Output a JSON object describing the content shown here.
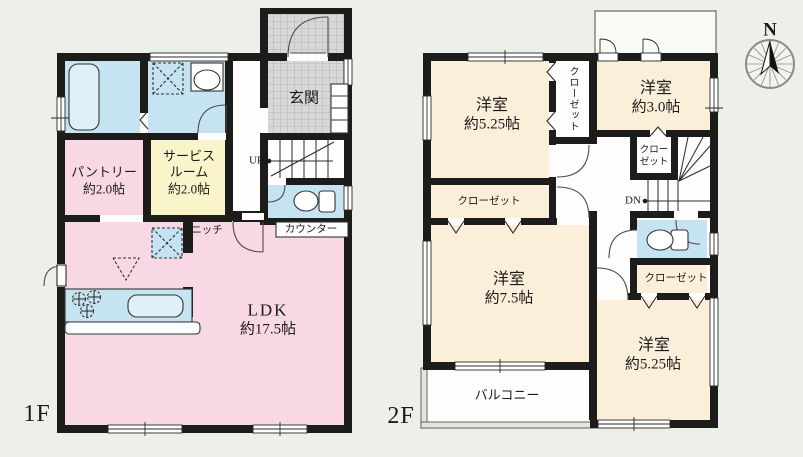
{
  "title": "2階建て住宅 間取り図 (1F / 2F)",
  "colors": {
    "background": "#edf0e8",
    "wall": "#1c1c1a",
    "room_pink": "#f8d8e4",
    "room_yellow": "#faf4ca",
    "room_blue": "#c6e3f2",
    "room_beige": "#fcefd9",
    "tile_gray": "#d8d8d8",
    "fixture_blue": "#dff0f9"
  },
  "floor1": {
    "floor_label": "1F",
    "genkan": "玄関",
    "pantry_name": "パントリー",
    "pantry_size": "約2.0帖",
    "service_name": "サービス",
    "service_name2": "ルーム",
    "service_size": "約2.0帖",
    "ldk_name": "LDK",
    "ldk_size": "約17.5帖",
    "niche": "ニッチ",
    "counter": "カウンター",
    "up": "UP"
  },
  "floor2": {
    "floor_label": "2F",
    "bedroom_nw_name": "洋室",
    "bedroom_nw_size": "約5.25帖",
    "bedroom_ne_name": "洋室",
    "bedroom_ne_size": "約3.0帖",
    "bedroom_sw_name": "洋室",
    "bedroom_sw_size": "約7.5帖",
    "bedroom_se_name": "洋室",
    "bedroom_se_size": "約5.25帖",
    "closet_vertical": "クローゼット",
    "closet_west": "クローゼット",
    "closet_hall_1": "クロー",
    "closet_hall_2": "ゼット",
    "closet_south": "クローゼット",
    "balcony": "バルコニー",
    "dn": "DN",
    "compass_north": "N"
  }
}
